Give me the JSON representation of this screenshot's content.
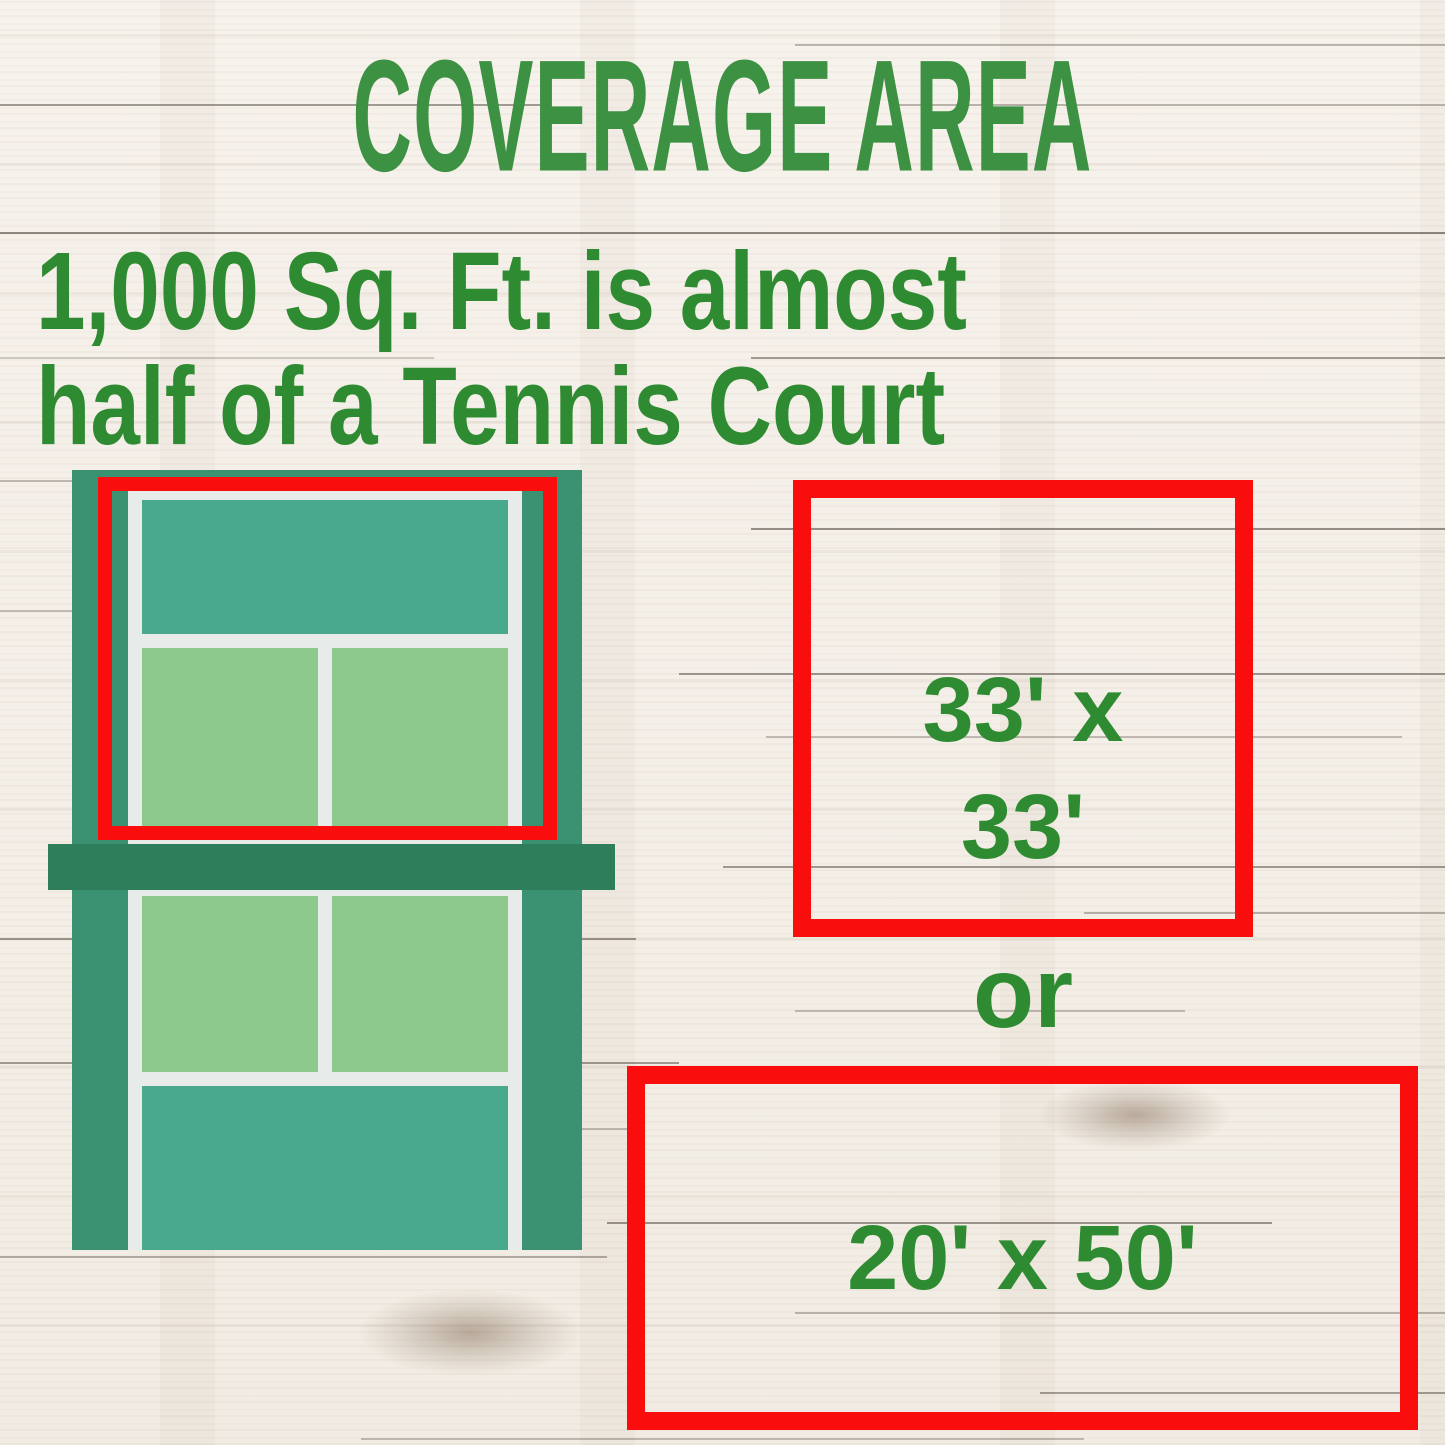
{
  "title": "COVERAGE AREA",
  "subtitle_line1": "1,000 Sq. Ft. is almost",
  "subtitle_line2": "half of a Tennis Court",
  "comparison": {
    "square_label_line1": "33' x",
    "square_label_line2": "33'",
    "divider": "or",
    "rect_label": "20' x 50'"
  },
  "illustration": {
    "name": "tennis-court-with-highlighted-half"
  },
  "colors": {
    "heading_green": "#3c9142",
    "text_green": "#2f8b31",
    "accent_red": "#f90d0d",
    "court_margin_green": "#3b9273",
    "court_teal": "#48a98c",
    "court_box_green": "#8dc88d",
    "court_net_green": "#2e7d5b",
    "court_line_white": "#e7ebe9",
    "wood_base": "#f3efe8"
  }
}
